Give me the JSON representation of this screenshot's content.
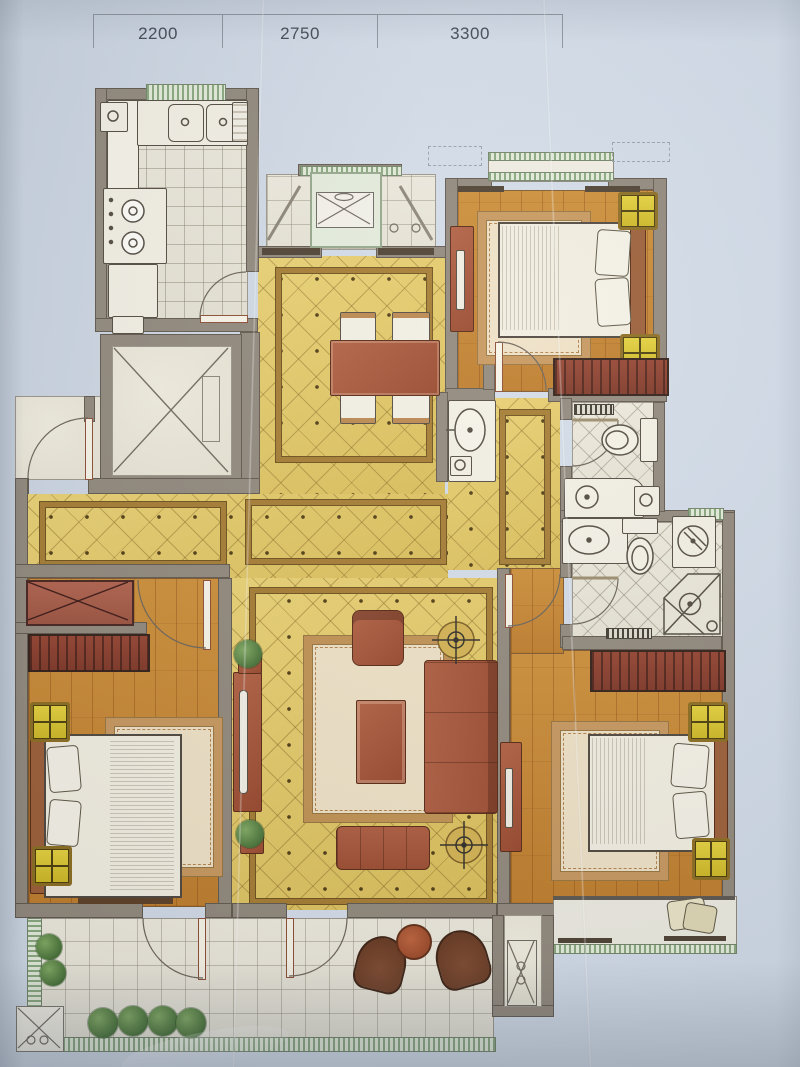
{
  "photo": {
    "kind": "apartment-floor-plan-photo"
  },
  "dimensions": {
    "labels": [
      "2200",
      "2750",
      "3300"
    ]
  },
  "palette": {
    "paper": "#cfd9e5",
    "wall_gray": "#8f8679",
    "wood_floor": "#c8862f",
    "gold_marble": "#e3c768",
    "light_tile": "#eae7db",
    "furniture_red": "#a8573a",
    "wardrobe_red": "#8a3a28",
    "nightstand_yellow": "#ddc526",
    "window_green": "#a9bf9b",
    "rug_tan": "#d9ba8c"
  },
  "rooms": [
    {
      "name": "kitchen"
    },
    {
      "name": "north-balcony"
    },
    {
      "name": "dining-room"
    },
    {
      "name": "bedroom-top-right"
    },
    {
      "name": "elevator"
    },
    {
      "name": "entry-hall"
    },
    {
      "name": "hallway"
    },
    {
      "name": "guest-bathroom"
    },
    {
      "name": "master-bathroom"
    },
    {
      "name": "living-room"
    },
    {
      "name": "bedroom-bottom-left"
    },
    {
      "name": "master-bedroom"
    },
    {
      "name": "south-balcony"
    }
  ]
}
